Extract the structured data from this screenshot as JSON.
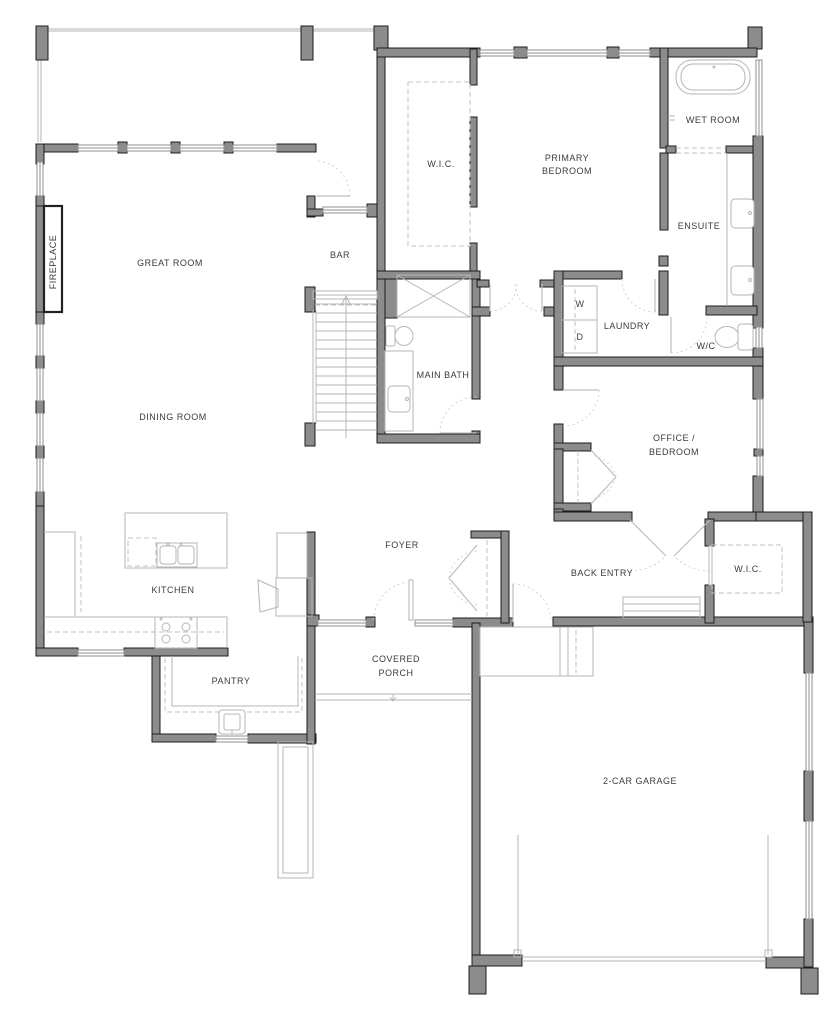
{
  "document": {
    "type": "residential floor plan",
    "floor": "main level"
  },
  "colors": {
    "background": "#ffffff",
    "wall_fill": "#8c8c8c",
    "wall_outline": "#1c1c1c",
    "thin_line": "#b5b5b5",
    "dashed_line": "#c2c2c2",
    "door_arc": "#d2d2d2",
    "label_text": "#3b3b3b"
  },
  "rooms": [
    {
      "id": "great-room",
      "lines": [
        "GREAT ROOM"
      ],
      "x": 170,
      "y": 266
    },
    {
      "id": "dining-room",
      "lines": [
        "DINING ROOM"
      ],
      "x": 173,
      "y": 420
    },
    {
      "id": "bar",
      "lines": [
        "BAR"
      ],
      "x": 340,
      "y": 258
    },
    {
      "id": "primary-wic",
      "lines": [
        "W.I.C."
      ],
      "x": 441,
      "y": 167
    },
    {
      "id": "primary-bedroom",
      "lines": [
        "PRIMARY",
        "BEDROOM"
      ],
      "x": 567,
      "y": 161,
      "y2": 174
    },
    {
      "id": "wet-room",
      "lines": [
        "WET ROOM"
      ],
      "x": 713,
      "y": 123
    },
    {
      "id": "ensuite",
      "lines": [
        "ENSUITE"
      ],
      "x": 699,
      "y": 229
    },
    {
      "id": "laundry",
      "lines": [
        "LAUNDRY"
      ],
      "x": 627,
      "y": 329
    },
    {
      "id": "wc",
      "lines": [
        "W/C"
      ],
      "x": 706,
      "y": 349
    },
    {
      "id": "main-bath",
      "lines": [
        "MAIN BATH"
      ],
      "x": 443,
      "y": 378
    },
    {
      "id": "office-bedroom",
      "lines": [
        "OFFICE /",
        "BEDROOM"
      ],
      "x": 674,
      "y": 441,
      "y2": 455
    },
    {
      "id": "kitchen",
      "lines": [
        "KITCHEN"
      ],
      "x": 173,
      "y": 593
    },
    {
      "id": "foyer",
      "lines": [
        "FOYER"
      ],
      "x": 402,
      "y": 548
    },
    {
      "id": "back-entry",
      "lines": [
        "BACK ENTRY"
      ],
      "x": 602,
      "y": 576
    },
    {
      "id": "back-wic",
      "lines": [
        "W.I.C."
      ],
      "x": 748,
      "y": 572
    },
    {
      "id": "pantry",
      "lines": [
        "PANTRY"
      ],
      "x": 231,
      "y": 684
    },
    {
      "id": "covered-porch",
      "lines": [
        "COVERED",
        "PORCH"
      ],
      "x": 396,
      "y": 662,
      "y2": 676
    },
    {
      "id": "garage",
      "lines": [
        "2-CAR GARAGE"
      ],
      "x": 640,
      "y": 784
    },
    {
      "id": "fireplace",
      "lines": [
        "FIREPLACE"
      ],
      "x": 56,
      "y": 262
    }
  ],
  "appliances": {
    "washer": "W",
    "dryer": "D"
  },
  "appliance_positions": {
    "washer_x": 580,
    "washer_y": 307,
    "dryer_x": 580,
    "dryer_y": 340
  }
}
